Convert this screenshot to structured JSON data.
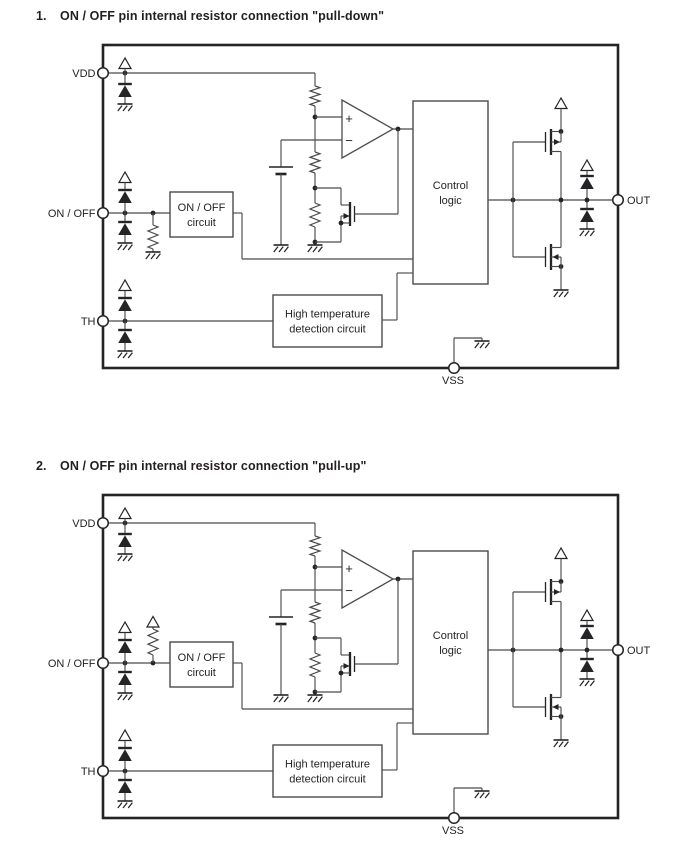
{
  "page": {
    "background": "#ffffff"
  },
  "colors": {
    "wire": "#4b4b4e",
    "dark": "#242427",
    "text": "#231f20"
  },
  "figures": [
    {
      "number": "1.",
      "title": "ON / OFF pin internal resistor connection \"pull-down\"",
      "variant": "pull-down"
    },
    {
      "number": "2.",
      "title": "ON / OFF pin internal resistor connection \"pull-up\"",
      "variant": "pull-up"
    }
  ],
  "diagram_labels": {
    "pins": {
      "vdd": "VDD",
      "onoff": "ON / OFF",
      "th": "TH",
      "out": "OUT",
      "vss": "VSS"
    },
    "blocks": {
      "onoff_circuit": [
        "ON / OFF",
        "circuit"
      ],
      "control_logic": [
        "Control",
        "logic"
      ],
      "high_temp": [
        "High temperature",
        "detection circuit"
      ]
    },
    "comparator": {
      "plus": "+",
      "minus": "−"
    }
  }
}
